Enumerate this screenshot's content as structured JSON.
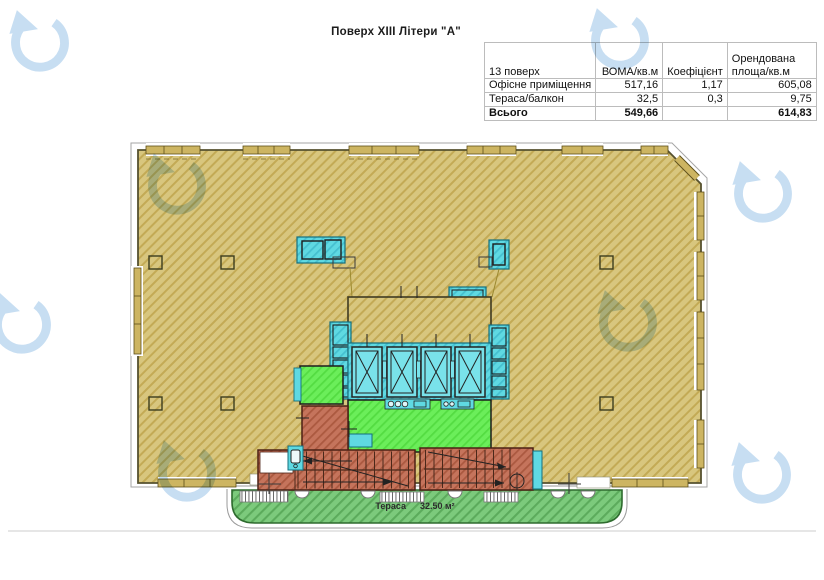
{
  "title": "Поверх XIII Літери \"А\"",
  "table": {
    "col_headers": {
      "c1": "13 поверх",
      "c2": "ВОМА/кв.м",
      "c3": "Коефіцієнт",
      "c4": "Орендована площа/кв.м"
    },
    "rows": [
      {
        "label": "Офісне приміщення",
        "boma": "517,16",
        "coef": "1,17",
        "rented": "605,08"
      },
      {
        "label": "Тераса/балкон",
        "boma": "32,5",
        "coef": "0,3",
        "rented": "9,75"
      }
    ],
    "total_row": {
      "label": "Всього",
      "boma": "549,66",
      "coef": "",
      "rented": "614,83"
    }
  },
  "plan": {
    "terrace_label": "Тераса",
    "terrace_area": "32.50 м²",
    "legend_colors": {
      "office_area": "#d8c67e",
      "core_shafts": "#5fd9e2",
      "elevator_lobby": "#6bee5a",
      "stairs": "#c5745c",
      "terrace": "#7cca7c",
      "watermark": "#c7def2"
    }
  }
}
